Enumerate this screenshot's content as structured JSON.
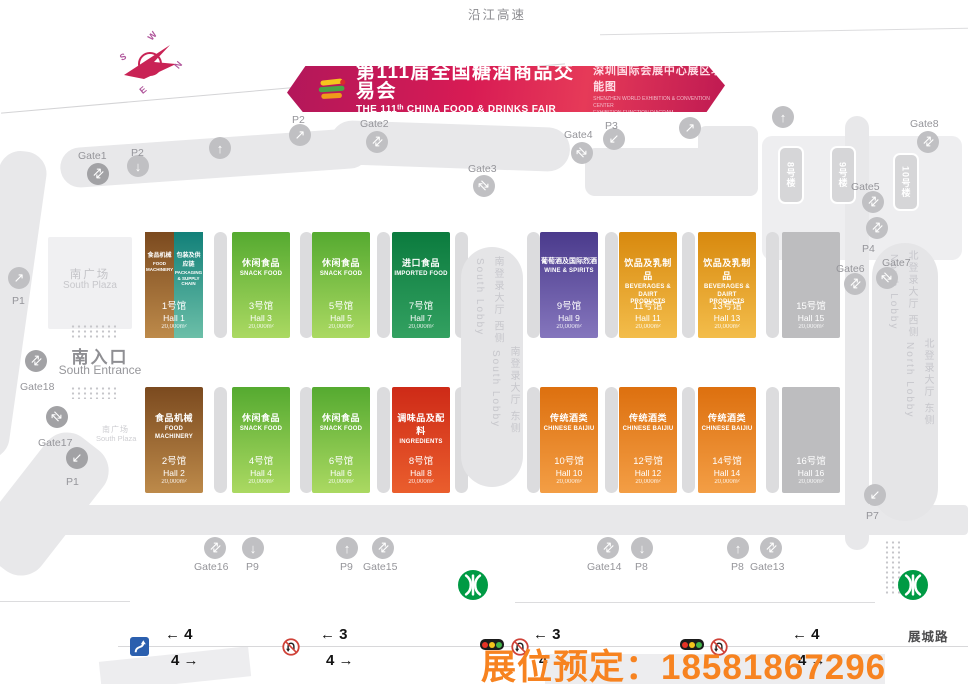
{
  "banner": {
    "title_cn": "第111届全国糖酒商品交易会",
    "title_en": "THE 111ᵗʰ CHINA FOOD & DRINKS FAIR",
    "subtitle_cn": "深圳国际会展中心展区功能图",
    "subtitle_en1": "SHENZHEN WORLD EXHIBITION & CONVENTION CENTER",
    "subtitle_en2": "EXHIBITION FUNCTION DIAGRAM"
  },
  "map_labels": {
    "top_highway": "沿江高速",
    "bottom_road": "展城路",
    "south_plaza_cn": "南广场",
    "south_plaza_en": "South Plaza",
    "south_plaza_small_cn": "南广场",
    "south_plaza_small_en": "South Plaza",
    "south_entrance_cn": "南入口",
    "south_entrance_en": "South Entrance",
    "south_lobby_west_cn": "南登录大厅 西侧",
    "south_lobby_west_en": "South Lobby",
    "south_lobby_east_cn": "南登录大厅 东侧",
    "south_lobby_east_en": "South Lobby",
    "north_lobby_west_cn": "北登录大厅 西侧",
    "north_lobby_west_en": "North Lobby",
    "north_lobby_east_cn": "北登录大厅 东侧",
    "north_lobby_east_en": "North Lobby"
  },
  "compass": {
    "n": "N",
    "e": "E",
    "s": "S",
    "w": "W"
  },
  "booking": {
    "text": "展位预定：18581867296",
    "color": "#f78320"
  },
  "buildings": [
    {
      "label": "8号楼",
      "x": 778,
      "y": 146
    },
    {
      "label": "9号楼",
      "x": 830,
      "y": 146
    },
    {
      "label": "10号楼",
      "x": 893,
      "y": 153
    }
  ],
  "halls": [
    {
      "num": "1号馆",
      "hall": "Hall 1",
      "area": "20,000m²",
      "row": 0,
      "col": 0,
      "split": [
        {
          "cn": "食品机械",
          "en": "FOOD MACHINERY",
          "top": "#7b4a1f",
          "bottom": "#bd8a4a"
        },
        {
          "cn": "包装及供应链",
          "en": "PACKAGING & SUPPLY CHAIN",
          "top": "#128079",
          "bottom": "#6cbfa8"
        }
      ]
    },
    {
      "num": "3号馆",
      "hall": "Hall 3",
      "area": "20,000m²",
      "row": 0,
      "col": 1,
      "cn": "休闲食品",
      "en": "SNACK FOOD",
      "top": "#55aa30",
      "bottom": "#abd962"
    },
    {
      "num": "5号馆",
      "hall": "Hall 5",
      "area": "20,000m²",
      "row": 0,
      "col": 2,
      "cn": "休闲食品",
      "en": "SNACK FOOD",
      "top": "#55aa30",
      "bottom": "#abd962"
    },
    {
      "num": "7号馆",
      "hall": "Hall 7",
      "area": "20,000m²",
      "row": 0,
      "col": 3,
      "cn": "进口食品",
      "en": "IMPORTED FOOD",
      "top": "#0b7b3e",
      "bottom": "#33a161"
    },
    {
      "num": "9号馆",
      "hall": "Hall 9",
      "area": "20,000m²",
      "row": 0,
      "col": 4,
      "cn": "葡萄酒及国际烈酒",
      "en": "WINE & SPIRITS",
      "top": "#4a3a8c",
      "bottom": "#8576bd",
      "cn_small": true
    },
    {
      "num": "11号馆",
      "hall": "Hall 11",
      "area": "20,000m²",
      "row": 0,
      "col": 5,
      "cn": "饮品及乳制品",
      "en": "BEVERAGES & DAIRT PRODUCTS",
      "top": "#d8890e",
      "bottom": "#f3bd4b"
    },
    {
      "num": "13号馆",
      "hall": "Hall 13",
      "area": "20,000m²",
      "row": 0,
      "col": 6,
      "cn": "饮品及乳制品",
      "en": "BEVERAGES & DAIRT PRODUCTS",
      "top": "#d8890e",
      "bottom": "#f3bd4b"
    },
    {
      "num": "15号馆",
      "hall": "Hall 15",
      "area": "20,000m²",
      "row": 0,
      "col": 7
    },
    {
      "num": "2号馆",
      "hall": "Hall 2",
      "area": "20,000m²",
      "row": 1,
      "col": 0,
      "cn": "食品机械",
      "en": "FOOD MACHINERY",
      "top": "#7b4a1f",
      "bottom": "#bd8a4a"
    },
    {
      "num": "4号馆",
      "hall": "Hall 4",
      "area": "20,000m²",
      "row": 1,
      "col": 1,
      "cn": "休闲食品",
      "en": "SNACK FOOD",
      "top": "#55aa30",
      "bottom": "#abd962"
    },
    {
      "num": "6号馆",
      "hall": "Hall 6",
      "area": "20,000m²",
      "row": 1,
      "col": 2,
      "cn": "休闲食品",
      "en": "SNACK FOOD",
      "top": "#55aa30",
      "bottom": "#abd962"
    },
    {
      "num": "8号馆",
      "hall": "Hall 8",
      "area": "20,000m²",
      "row": 1,
      "col": 3,
      "cn": "调味品及配料",
      "en": "INGREDIENTS",
      "top": "#ce2a17",
      "bottom": "#ea5e2d"
    },
    {
      "num": "10号馆",
      "hall": "Hall 10",
      "area": "20,000m²",
      "row": 1,
      "col": 4,
      "cn": "传统酒类",
      "en": "CHINESE BAIJIU",
      "top": "#dd700f",
      "bottom": "#f39e45"
    },
    {
      "num": "12号馆",
      "hall": "Hall 12",
      "area": "20,000m²",
      "row": 1,
      "col": 5,
      "cn": "传统酒类",
      "en": "CHINESE BAIJIU",
      "top": "#dd700f",
      "bottom": "#f39e45"
    },
    {
      "num": "14号馆",
      "hall": "Hall 14",
      "area": "20,000m²",
      "row": 1,
      "col": 6,
      "cn": "传统酒类",
      "en": "CHINESE BAIJIU",
      "top": "#dd700f",
      "bottom": "#f39e45"
    },
    {
      "num": "16号馆",
      "hall": "Hall 16",
      "area": "20,000m²",
      "row": 1,
      "col": 7
    }
  ],
  "gates": [
    {
      "label": "Gate1",
      "cx": 98,
      "cy": 174,
      "lx": 78,
      "ly": 150,
      "dark": true,
      "glyph": "updown"
    },
    {
      "label": "P2",
      "cx": 138,
      "cy": 166,
      "lx": 131,
      "ly": 147,
      "glyph": "down"
    },
    {
      "label": "P2",
      "cx": 300,
      "cy": 135,
      "lx": 292,
      "ly": 114,
      "glyph": "upright"
    },
    {
      "label": "Gate2",
      "cx": 377,
      "cy": 142,
      "lx": 360,
      "ly": 118,
      "glyph": "updown"
    },
    {
      "label": "",
      "cx": 220,
      "cy": 148,
      "glyph": "up"
    },
    {
      "label": "Gate3",
      "cx": 484,
      "cy": 186,
      "lx": 468,
      "ly": 163,
      "glyph": "diag"
    },
    {
      "label": "Gate4",
      "cx": 582,
      "cy": 153,
      "lx": 564,
      "ly": 129,
      "glyph": "diag"
    },
    {
      "label": "P3",
      "cx": 614,
      "cy": 139,
      "lx": 605,
      "ly": 120,
      "glyph": "downleft"
    },
    {
      "label": "",
      "cx": 690,
      "cy": 128,
      "glyph": "upright"
    },
    {
      "label": "",
      "cx": 783,
      "cy": 117,
      "glyph": "up"
    },
    {
      "label": "Gate8",
      "cx": 928,
      "cy": 142,
      "lx": 910,
      "ly": 118,
      "glyph": "updown"
    },
    {
      "label": "Gate5",
      "cx": 873,
      "cy": 202,
      "lx": 851,
      "ly": 181,
      "glyph": "updown"
    },
    {
      "label": "",
      "cx": 877,
      "cy": 228,
      "glyph": "updown"
    },
    {
      "label": "P4",
      "lx": 862,
      "ly": 243
    },
    {
      "label": "Gate7",
      "cx": 887,
      "cy": 278,
      "lx": 882,
      "ly": 257,
      "glyph": "diag"
    },
    {
      "label": "Gate6",
      "cx": 855,
      "cy": 284,
      "lx": 836,
      "ly": 263,
      "glyph": "updown"
    },
    {
      "label": "P1",
      "cx": 19,
      "cy": 278,
      "lx": 12,
      "ly": 295,
      "glyph": "upright"
    },
    {
      "label": "Gate18",
      "cx": 36,
      "cy": 361,
      "lx": 20,
      "ly": 381,
      "dark": true,
      "glyph": "updown"
    },
    {
      "label": "Gate17",
      "cx": 57,
      "cy": 417,
      "lx": 38,
      "ly": 437,
      "dark": true,
      "glyph": "diag"
    },
    {
      "label": "P1",
      "cx": 77,
      "cy": 458,
      "lx": 66,
      "ly": 476,
      "dark": true,
      "glyph": "downleft"
    },
    {
      "label": "P7",
      "cx": 875,
      "cy": 495,
      "lx": 866,
      "ly": 510,
      "glyph": "downleft"
    },
    {
      "label": "Gate16",
      "cx": 215,
      "cy": 548,
      "lx": 194,
      "ly": 561,
      "glyph": "updown"
    },
    {
      "label": "P9",
      "cx": 253,
      "cy": 548,
      "lx": 246,
      "ly": 561,
      "glyph": "down"
    },
    {
      "label": "P9",
      "cx": 347,
      "cy": 548,
      "lx": 340,
      "ly": 561,
      "glyph": "up"
    },
    {
      "label": "Gate15",
      "cx": 383,
      "cy": 548,
      "lx": 363,
      "ly": 561,
      "glyph": "updown"
    },
    {
      "label": "Gate14",
      "cx": 608,
      "cy": 548,
      "lx": 587,
      "ly": 561,
      "glyph": "updown"
    },
    {
      "label": "P8",
      "cx": 642,
      "cy": 548,
      "lx": 635,
      "ly": 561,
      "glyph": "down"
    },
    {
      "label": "P8",
      "cx": 738,
      "cy": 548,
      "lx": 731,
      "ly": 561,
      "glyph": "up"
    },
    {
      "label": "Gate13",
      "cx": 771,
      "cy": 548,
      "lx": 750,
      "ly": 561,
      "glyph": "updown"
    }
  ],
  "lanes": [
    {
      "left": "4",
      "right": "4",
      "x": 165
    },
    {
      "left": "3",
      "right": "4",
      "x": 320
    },
    {
      "left": "3",
      "right": "4",
      "x": 533
    },
    {
      "left": "4",
      "right": "4",
      "x": 792
    }
  ],
  "signs": {
    "no_uturn_x": [
      282,
      511,
      710
    ],
    "traffic_light_x": [
      480,
      680
    ],
    "u_turn_sign": {
      "x": 130,
      "y": 637
    }
  },
  "metro": {
    "color": "#009a44",
    "positions": [
      [
        458,
        570
      ],
      [
        898,
        570
      ]
    ]
  },
  "layout_data": {
    "road_shapes": [
      [
        60,
        138,
        310,
        40,
        20,
        -4,
        ""
      ],
      [
        330,
        124,
        240,
        44,
        22,
        2,
        ""
      ],
      [
        585,
        148,
        150,
        48,
        10,
        0,
        ""
      ],
      [
        698,
        126,
        60,
        70,
        8,
        0,
        ""
      ],
      [
        762,
        136,
        200,
        124,
        10,
        0,
        "#eeeef0"
      ],
      [
        845,
        116,
        24,
        434,
        12,
        0,
        ""
      ],
      [
        60,
        505,
        908,
        30,
        4,
        0,
        ""
      ],
      [
        -20,
        150,
        48,
        310,
        22,
        8,
        ""
      ],
      [
        8,
        428,
        72,
        152,
        26,
        38,
        ""
      ],
      [
        48,
        237,
        84,
        92,
        2,
        0,
        "#f0f0f2"
      ],
      [
        100,
        654,
        150,
        30,
        0,
        -6,
        "#ededef"
      ],
      [
        545,
        654,
        340,
        30,
        0,
        0,
        "#ededef"
      ],
      [
        118,
        646,
        850,
        1,
        0,
        0,
        "#d8d8da"
      ],
      [
        0,
        601,
        130,
        1,
        0,
        0,
        "#dcdcde"
      ],
      [
        515,
        602,
        360,
        1,
        0,
        0,
        "#dcdcde"
      ],
      [
        600,
        31,
        368,
        1,
        0,
        -1,
        "#dcdcde"
      ],
      [
        0,
        88,
        566,
        1,
        0,
        -5,
        "#d4d4d6"
      ]
    ],
    "pillar_xs": [
      214,
      300,
      377,
      455,
      527,
      605,
      682,
      766
    ],
    "pillar_ys": [
      232,
      387
    ],
    "hall_lefts": [
      145,
      232,
      312,
      392,
      540,
      619,
      698,
      782
    ],
    "hall_tops": [
      232,
      387
    ],
    "dot_strips": [
      [
        70,
        324,
        46,
        16
      ],
      [
        70,
        386,
        46,
        13
      ],
      [
        884,
        540,
        16,
        56
      ]
    ]
  }
}
